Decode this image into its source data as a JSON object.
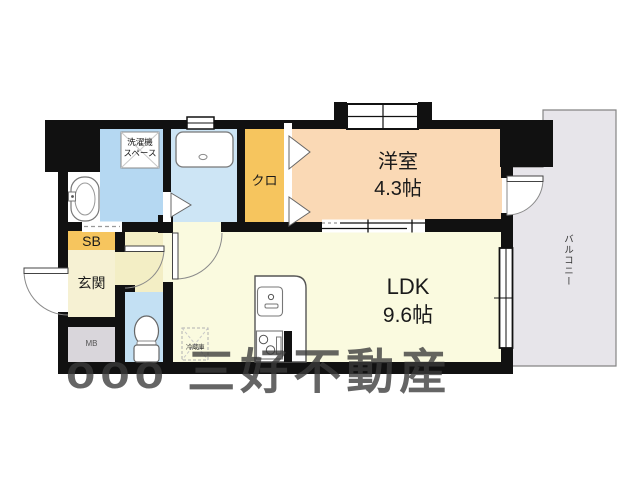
{
  "plan": {
    "rooms": {
      "bedroom": {
        "name": "洋室",
        "size": "4.3帖"
      },
      "ldk": {
        "name": "LDK",
        "size": "9.6帖"
      },
      "closet": {
        "name": "クロ"
      },
      "entrance": {
        "name": "玄関"
      },
      "shoe_box": {
        "name": "SB"
      },
      "meter_box": {
        "name": "MB"
      },
      "balcony": {
        "name": "バルコニー"
      },
      "laundry_space": {
        "line1": "洗濯機",
        "line2": "スペース"
      },
      "fridge": {
        "name": "冷蔵庫"
      }
    },
    "watermark": "ooo 三好不動産",
    "colors": {
      "wall": "#111111",
      "washroom": "#b5d8f2",
      "bathroom": "#cde5f5",
      "toilet": "#c3e0f3",
      "closet_orange": "#f6c55e",
      "bedroom_peach": "#fad9b5",
      "ldk_cream": "#fafadf",
      "hall_yellow": "#f3eec5",
      "genkan_cream": "#f6f1d3",
      "mb_gray": "#d9d6db",
      "balcony_gray": "#e7e5ea"
    }
  }
}
